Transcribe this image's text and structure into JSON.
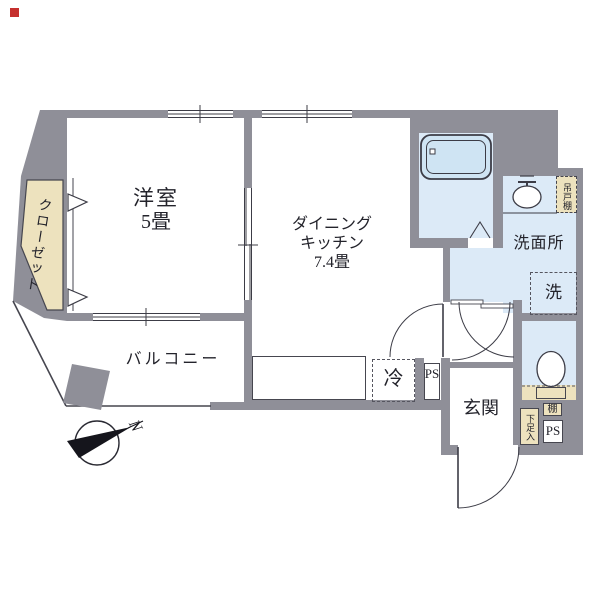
{
  "page": {
    "background": "#ffffff",
    "corner_marker_color": "#c5302e"
  },
  "compass": {
    "north_label": "N"
  },
  "rooms": {
    "western_room": {
      "name": "洋室",
      "size": "5畳"
    },
    "dining_kitchen": {
      "name_line1": "ダイニング",
      "name_line2": "キッチン",
      "size": "7.4畳"
    },
    "balcony": {
      "name": "バルコニー"
    },
    "washroom": {
      "name": "洗面所"
    },
    "entrance": {
      "name": "玄関"
    },
    "closet": {
      "name": "クローゼット"
    }
  },
  "fixtures": {
    "refrigerator_label": "冷",
    "washing_machine_label": "洗",
    "pipe_space_kitchen_label": "PS",
    "pipe_space_entrance_label": "PS",
    "hanging_cupboard_label": "吊戸棚",
    "shoe_cabinet_label": "下足入",
    "shelf_label": "棚"
  },
  "colors": {
    "wall": "#8f8f98",
    "wet_area_floor": "#dceaf7",
    "bathtub": "#cfe4f3",
    "storage_beige": "#ede2be",
    "line": "#3c3c46",
    "text": "#23232b"
  }
}
